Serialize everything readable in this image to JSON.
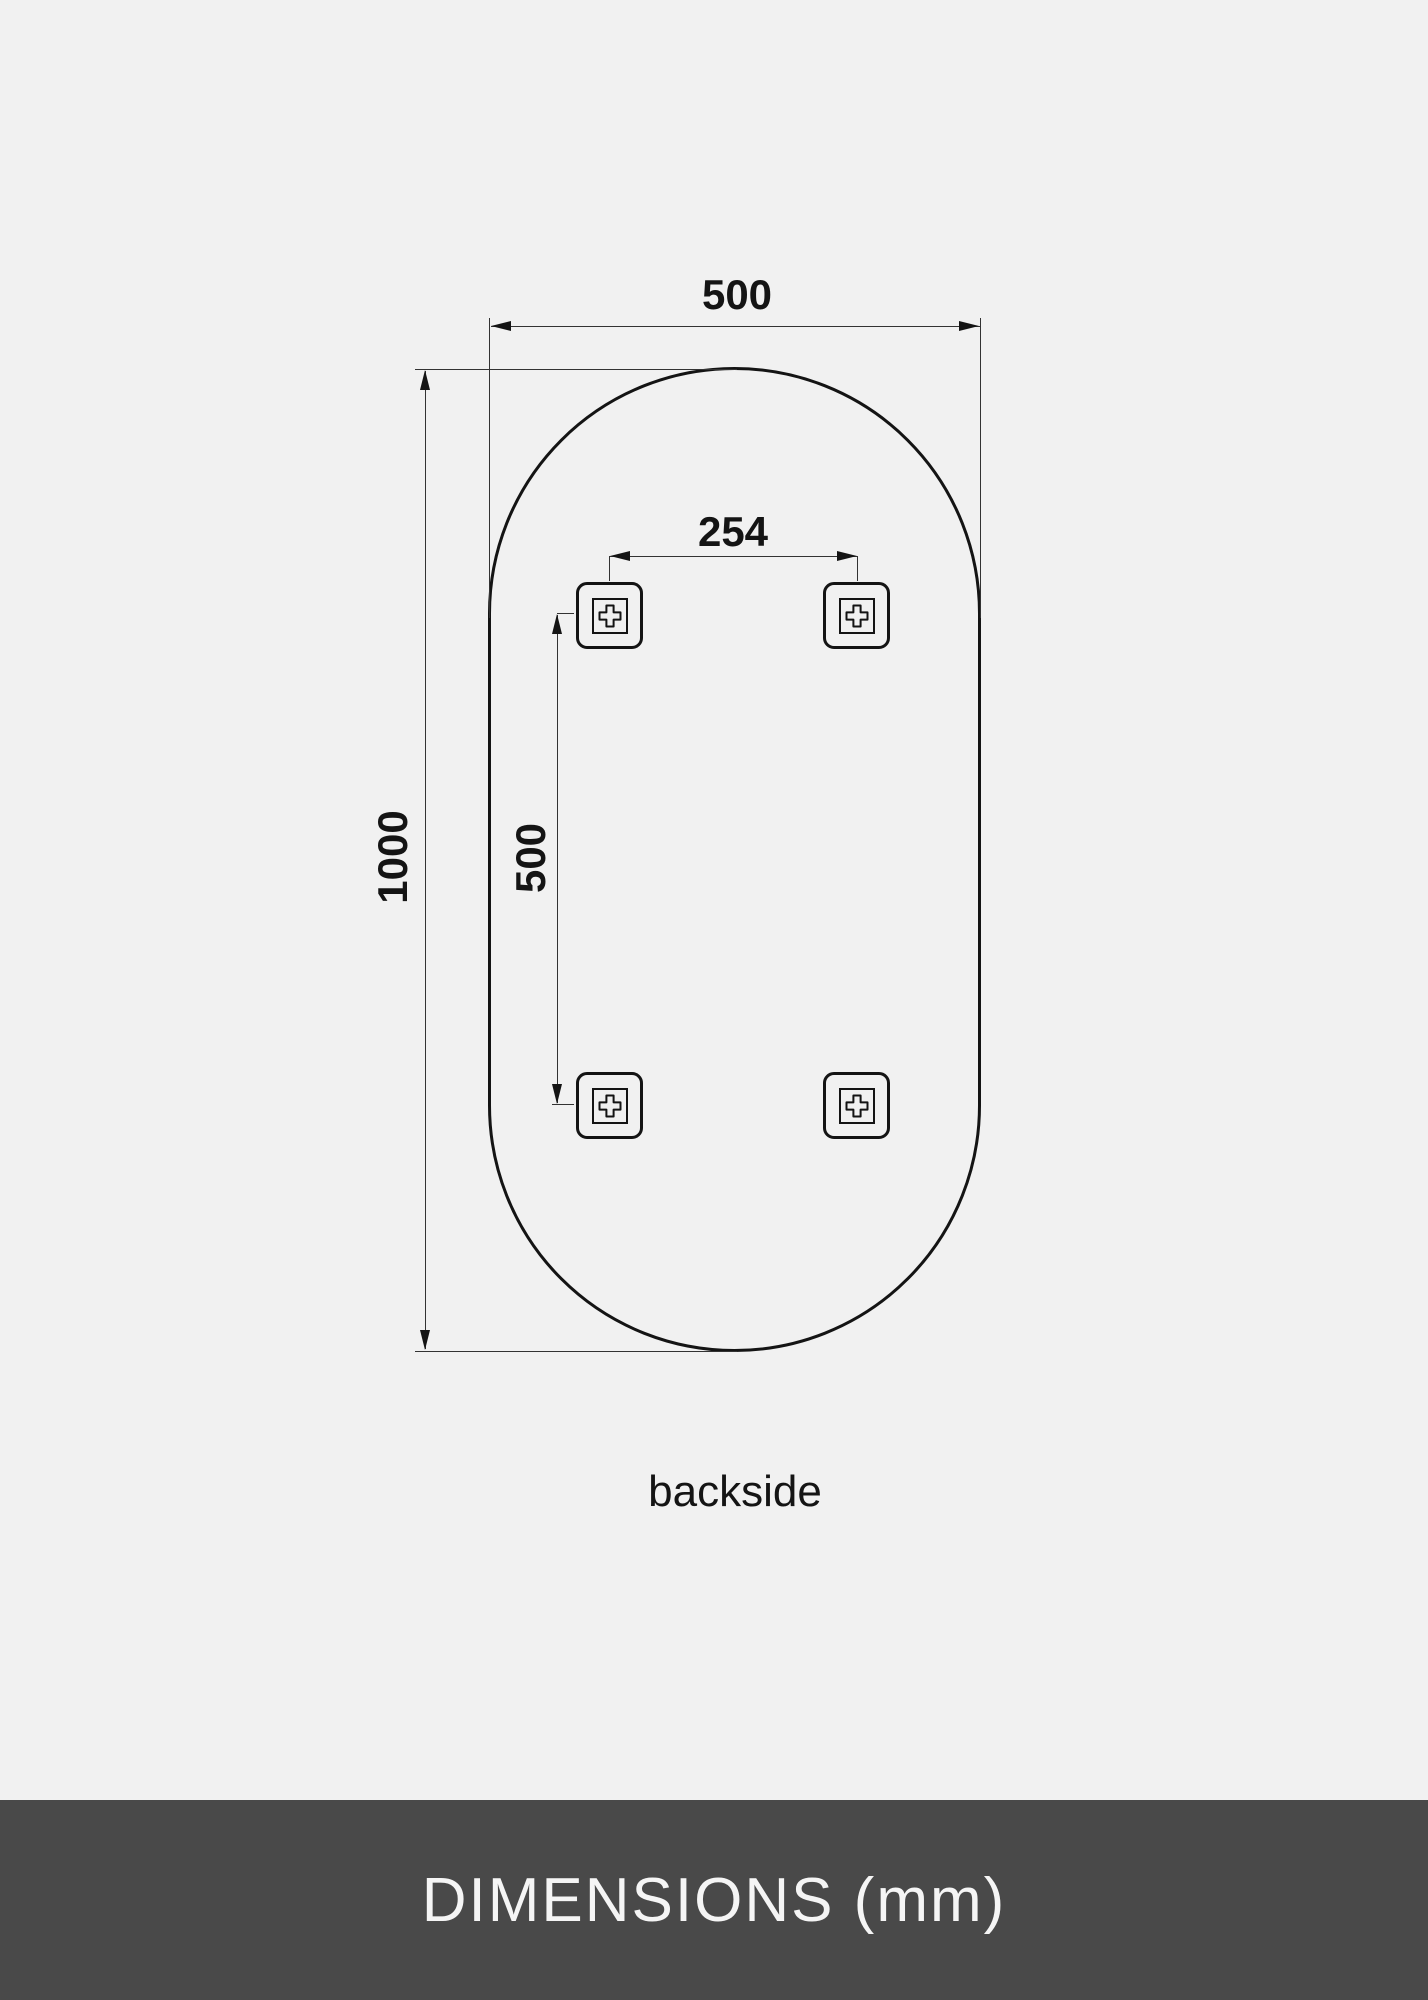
{
  "diagram": {
    "width_label": "500",
    "height_label": "1000",
    "hole_spacing_horizontal_label": "254",
    "hole_spacing_vertical_label": "500",
    "view_label": "backside"
  },
  "footer": {
    "title": "DIMENSIONS (mm)"
  },
  "colors": {
    "background": "#f1f1f1",
    "line": "#141414",
    "thin_line": "#333333",
    "footer_background": "#494949",
    "footer_text": "#f5f5f5"
  }
}
